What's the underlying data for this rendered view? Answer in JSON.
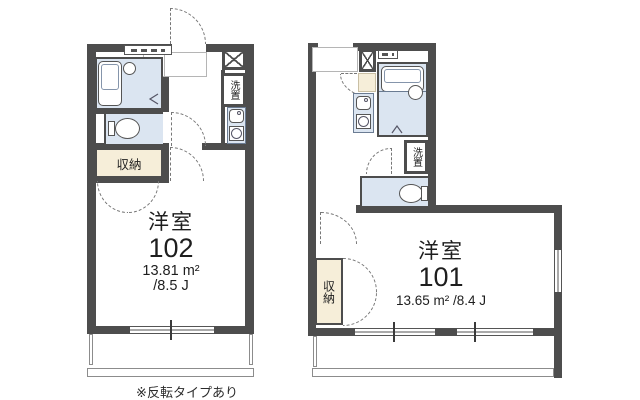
{
  "colors": {
    "wall": "#4d4d4d",
    "water_fill": "#dbe5f1",
    "closet_fill": "#f6eed9"
  },
  "footnote": "※反転タイプあり",
  "units": {
    "left": {
      "room_label": "洋室",
      "room_number": "102",
      "area_m2": "13.81 m²",
      "area_jo": "/8.5 J",
      "closet_label": "収納",
      "laundry_label": "洗置"
    },
    "right": {
      "room_label": "洋室",
      "room_number": "101",
      "area": "13.65 m² /8.4 J",
      "closet_label": "収納",
      "laundry_label": "洗置"
    }
  }
}
